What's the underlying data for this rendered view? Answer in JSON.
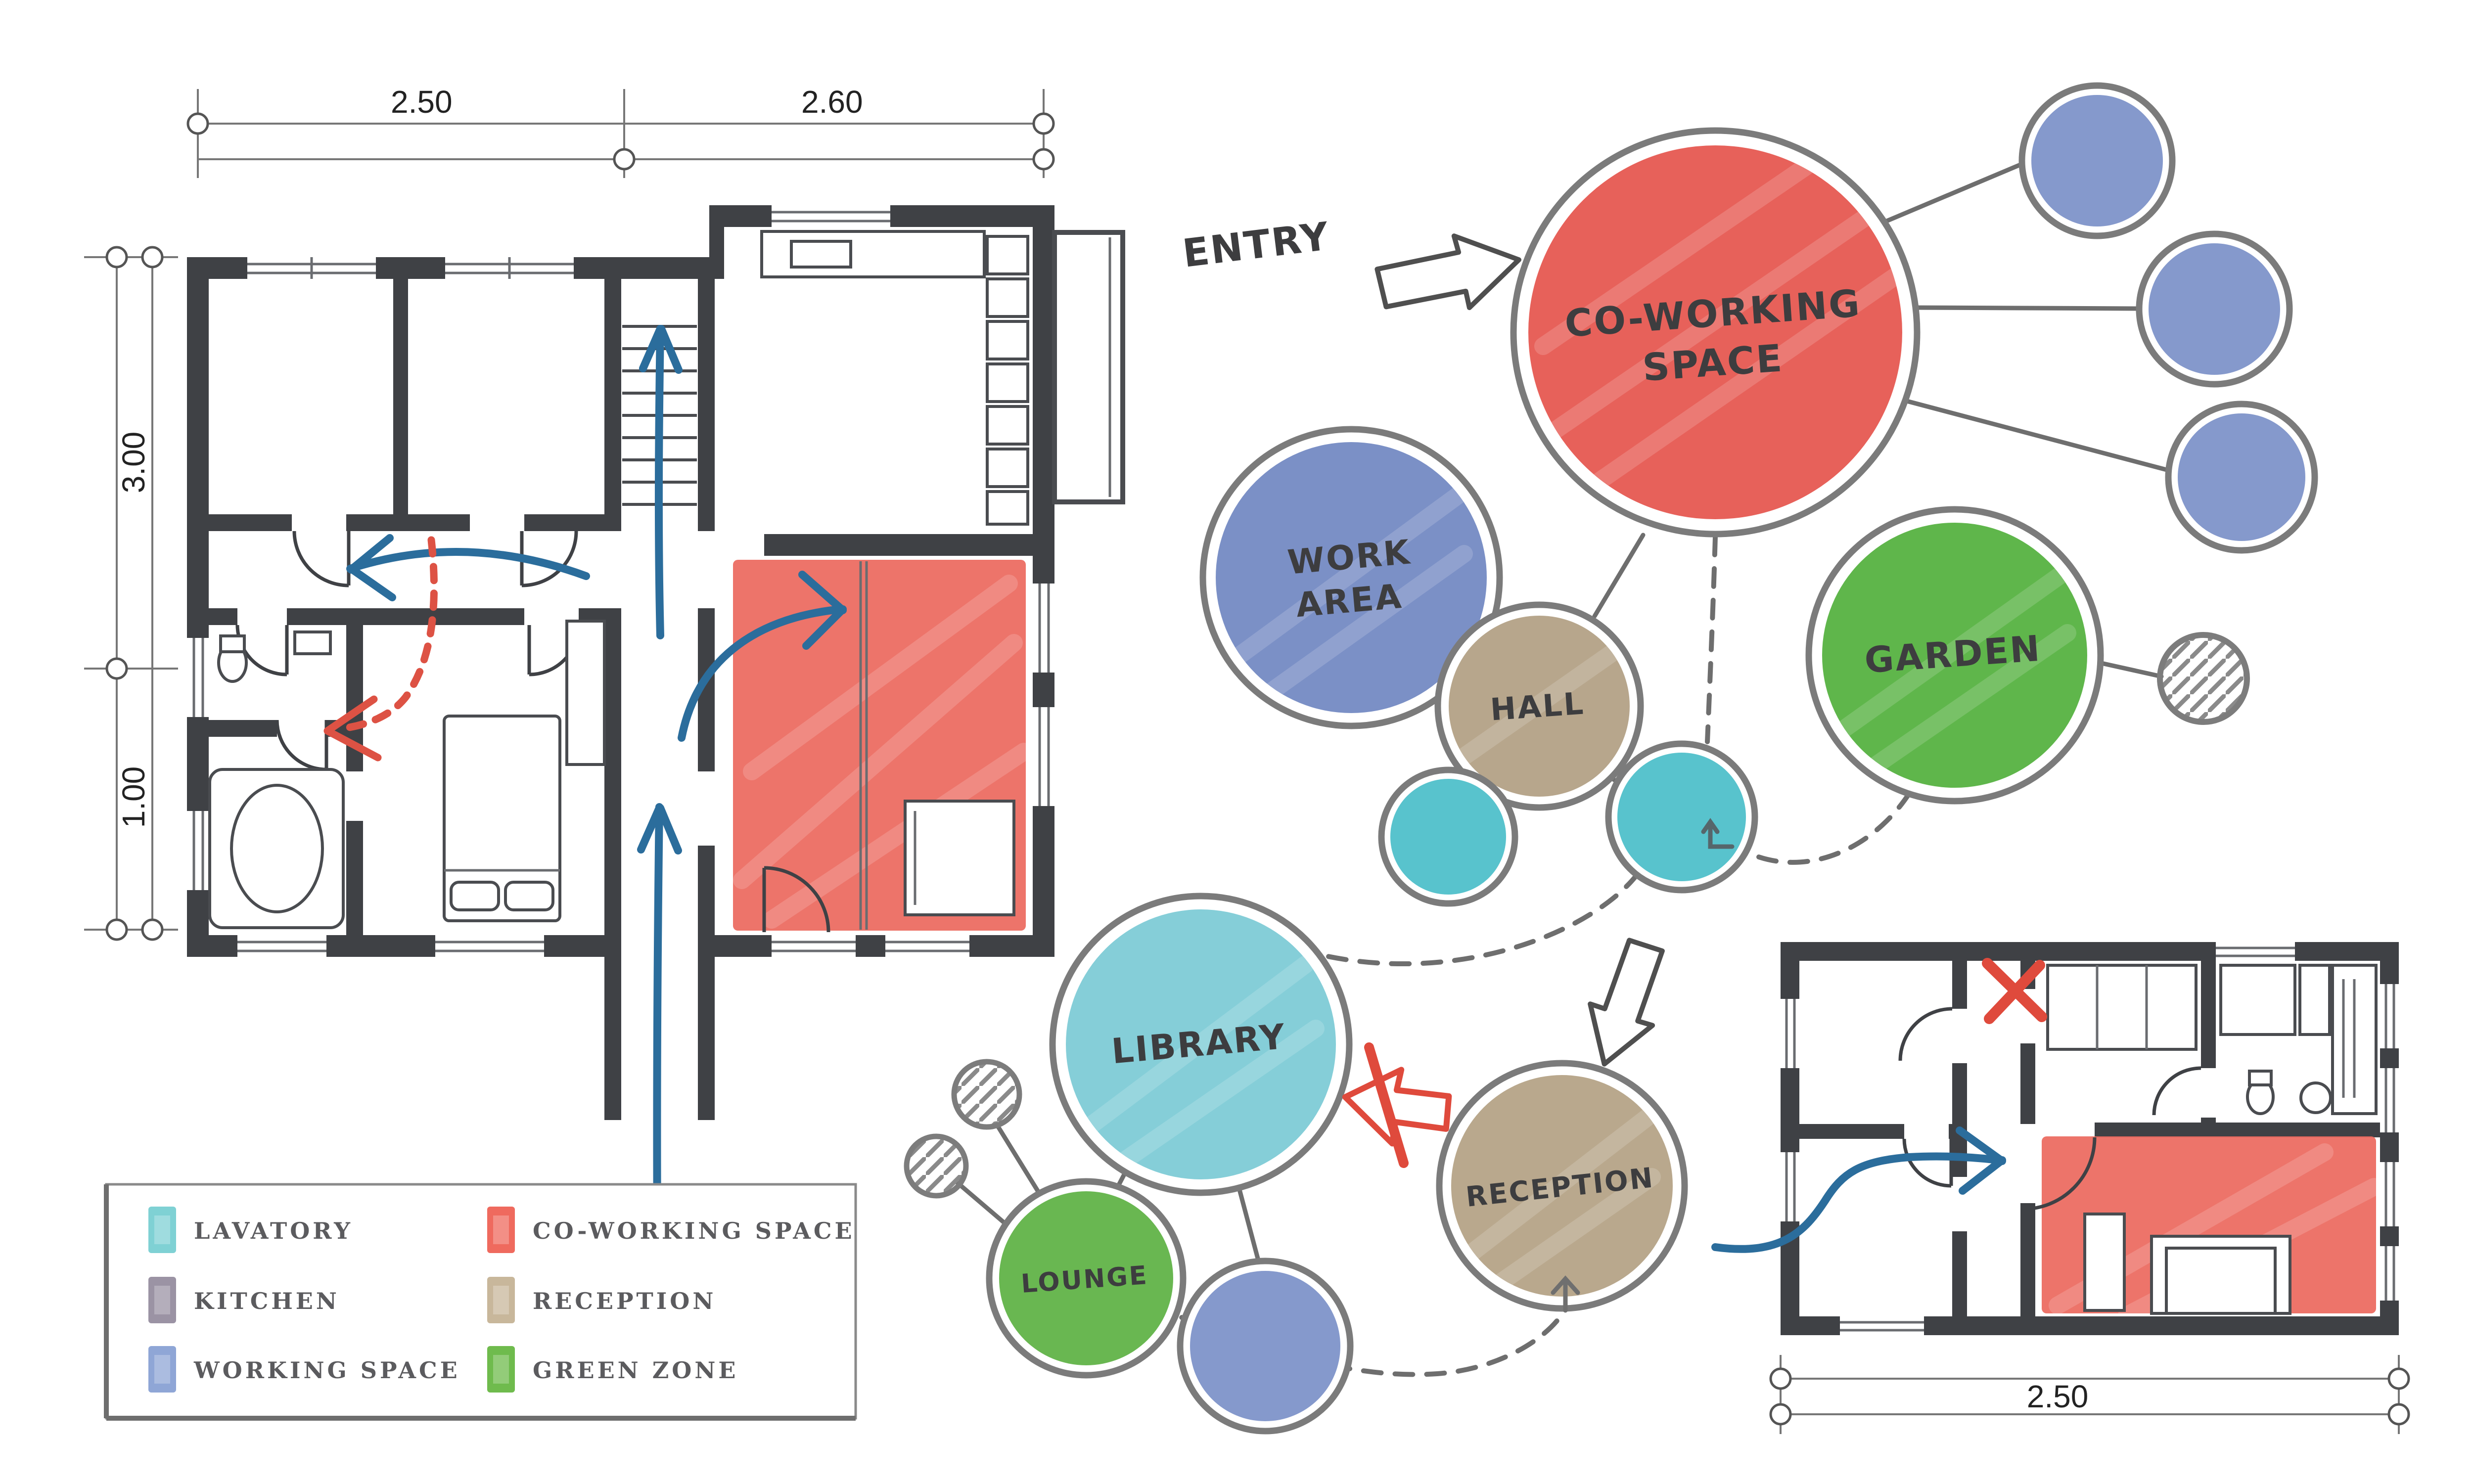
{
  "entry_label": "ENTRY",
  "legend": {
    "items": [
      {
        "label": "LAVATORY",
        "color": "#7fd1d4"
      },
      {
        "label": "KITCHEN",
        "color": "#9b93a4"
      },
      {
        "label": "WORKING SPACE",
        "color": "#8fa6d6"
      },
      {
        "label": "CO-WORKING SPACE",
        "color": "#ef6a5e"
      },
      {
        "label": "RECEPTION",
        "color": "#c8b79b"
      },
      {
        "label": "GREEN ZONE",
        "color": "#6fbb4d"
      }
    ]
  },
  "bubbles": {
    "coworking": {
      "line1": "CO-WORKING",
      "line2": "SPACE",
      "color": "#e7615a"
    },
    "work": {
      "line1": "WORK",
      "line2": "AREA",
      "color": "#7b90c6"
    },
    "hall": {
      "label": "HALL",
      "color": "#b7a68c"
    },
    "garden": {
      "label": "GARDEN",
      "color": "#5fb64b"
    },
    "library": {
      "label": "LIBRARY",
      "color": "#85ced8"
    },
    "lounge": {
      "label": "LOUNGE",
      "color": "#69b751"
    },
    "reception": {
      "label": "RECEPTION",
      "color": "#b9a88d"
    },
    "lavatory_small": {
      "color": "#58c3cd"
    },
    "working_small": {
      "color": "#8599cc"
    }
  },
  "dimensions": {
    "plan1_top_left": "2.50",
    "plan1_top_right": "2.60",
    "plan1_left_upper": "3.00",
    "plan1_left_lower": "1.00",
    "plan2_bottom": "2.50"
  },
  "colors": {
    "wall": "#3f4145",
    "blue_arrow": "#2b6d9c",
    "red_accent": "#dd5244",
    "red_overlay": "#ec685d"
  }
}
